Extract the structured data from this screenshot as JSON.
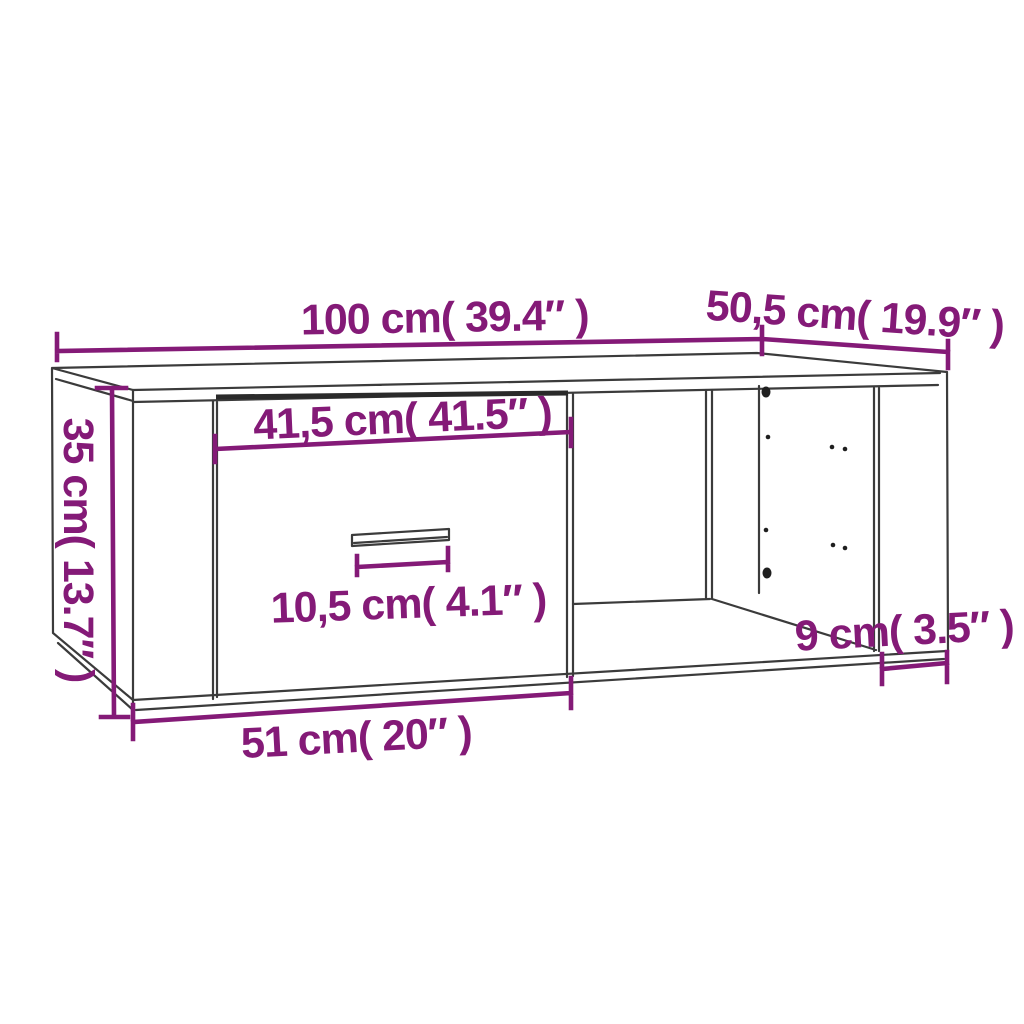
{
  "diagram": {
    "kind": "furniture-dimension-diagram",
    "colors": {
      "dimension": "#841A77",
      "line": "#3b3b3b",
      "shadow": "#2a2a2a",
      "hole": "#1f1f1f",
      "background": "#ffffff"
    },
    "dims": {
      "top_width": "100 cm( 39.4″ )",
      "top_depth": "50,5 cm( 19.9″ )",
      "left_height": "35 cm( 13.7″ )",
      "drawer_width": "41,5 cm( 41.5″ )",
      "handle_width": "10,5 cm( 4.1″ )",
      "right_inset": "9 cm( 3.5″ )",
      "bottom_width": "51 cm( 20″ )"
    }
  }
}
